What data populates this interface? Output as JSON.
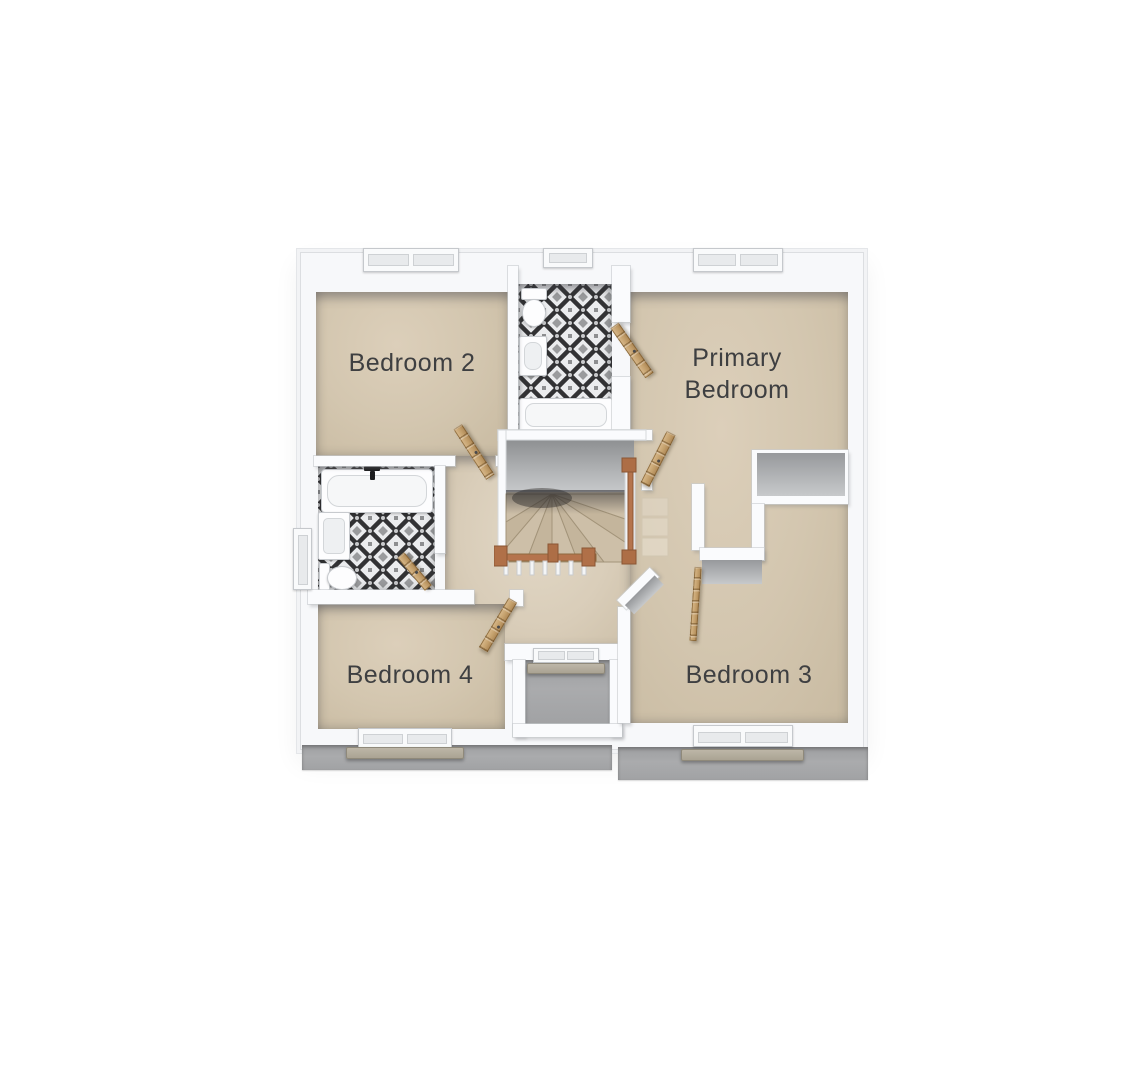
{
  "plan": {
    "view": "floor-plan-3d-top-down",
    "rooms": [
      {
        "id": "bedroom-2",
        "label": "Bedroom 2"
      },
      {
        "id": "primary-bedroom",
        "label": "Primary Bedroom"
      },
      {
        "id": "bedroom-4",
        "label": "Bedroom 4"
      },
      {
        "id": "bedroom-3",
        "label": "Bedroom 3"
      }
    ],
    "palette": {
      "background": "#ffffff",
      "wall": "#fafbfd",
      "carpet": "#d3c6af",
      "hall_carpet": "#d9cdb9",
      "roof_ledge": "#a5a6a8",
      "tile_dark": "#323234",
      "tile_gray": "#9a9b9d",
      "tile_light": "#ebecee",
      "door_wood": "#c29a68",
      "stair_rail_copper": "#b5744d",
      "stone_sill": "#b2ab9c",
      "label_text": "#3e3f41"
    }
  }
}
